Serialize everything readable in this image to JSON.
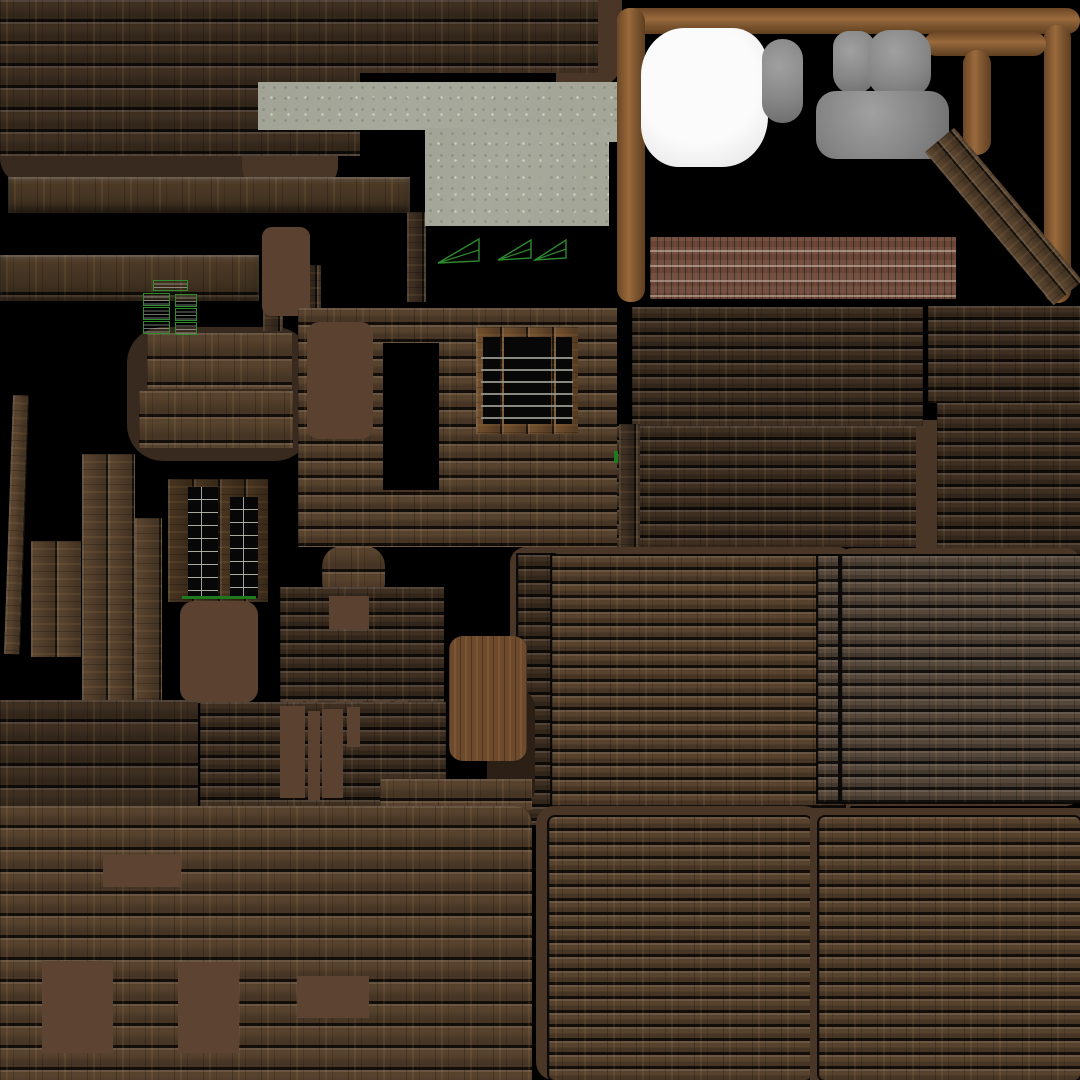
{
  "meta": {
    "background": "#000000",
    "canvas_width": 1080,
    "canvas_height": 1080
  },
  "palette": {
    "background": "#000000",
    "wood_dark": "#3e2f21",
    "wood_mid": "#57422d",
    "wood_gray": "#55473a",
    "flat_brown": "#5a4130",
    "shadow_brown": "#4a3626",
    "blob_brown": "#382a1e",
    "concrete_gray": "#a7a99c",
    "brick_red": "#6f5243",
    "frame_brown": "#9a6a3c",
    "white_blob": "#f3f3f3",
    "gray_blob": "#8f8f8f",
    "wireframe_green": "#2d8a2d"
  },
  "patches": [
    {
      "name": "scallop-shadow-band",
      "cls": "flat",
      "c": "#382a1e",
      "x": 0,
      "y": 132,
      "w": 338,
      "h": 52,
      "r": "0 0 26px 26px"
    },
    {
      "name": "concrete-left-shadow",
      "cls": "flat",
      "c": "#4a3626",
      "x": 242,
      "y": 122,
      "w": 96,
      "h": 68,
      "r": "24px"
    },
    {
      "name": "topwood-right-shadow",
      "cls": "flat",
      "c": "#4a3626",
      "x": 556,
      "y": 0,
      "w": 66,
      "h": 88,
      "r": "0 0 28px 0"
    },
    {
      "name": "topleft-wood-lower",
      "cls": "wood rows-22 shade-dark",
      "x": 0,
      "y": 0,
      "w": 360,
      "h": 156
    },
    {
      "name": "topleft-wood-upper",
      "cls": "wood rows-22 shade-dark",
      "x": 0,
      "y": 0,
      "w": 598,
      "h": 73
    },
    {
      "name": "beam-1",
      "cls": "wood rows-40 shade-beam beam",
      "x": 8,
      "y": 177,
      "w": 402,
      "h": 36
    },
    {
      "name": "post-1",
      "cls": "vgrain rows-17 shade-dark",
      "x": 407,
      "y": 212,
      "w": 19,
      "h": 90
    },
    {
      "name": "beam-2",
      "cls": "wood rows-40 shade-beam beam",
      "x": 0,
      "y": 255,
      "w": 259,
      "h": 46
    },
    {
      "name": "concrete-slab",
      "cls": "concrete",
      "x": 258,
      "y": 82,
      "w": 366,
      "h": 48
    },
    {
      "name": "concrete-block",
      "cls": "concrete",
      "x": 425,
      "y": 128,
      "w": 184,
      "h": 98
    },
    {
      "name": "concrete-step",
      "cls": "concrete",
      "x": 592,
      "y": 128,
      "w": 32,
      "h": 14
    },
    {
      "name": "frame-top-bar",
      "cls": "frame",
      "x": 617,
      "y": 8,
      "w": 463,
      "h": 26,
      "r": "13px"
    },
    {
      "name": "frame-left-bar",
      "cls": "frame dirH",
      "x": 617,
      "y": 8,
      "w": 28,
      "h": 294,
      "r": "13px"
    },
    {
      "name": "frame-right-bar",
      "cls": "frame dirH",
      "x": 1044,
      "y": 25,
      "w": 27,
      "h": 278,
      "r": "13px"
    },
    {
      "name": "frame-t-bar",
      "cls": "frame",
      "x": 924,
      "y": 32,
      "w": 122,
      "h": 24,
      "r": "12px"
    },
    {
      "name": "frame-t-stem",
      "cls": "frame dirH",
      "x": 963,
      "y": 50,
      "w": 28,
      "h": 105,
      "r": "14px"
    },
    {
      "name": "white-blob",
      "cls": "whiteblob",
      "x": 641,
      "y": 28,
      "w": 127,
      "h": 139,
      "r": "34% 28% 36% 30%"
    },
    {
      "name": "gray-blob-small",
      "cls": "grayblob",
      "x": 762,
      "y": 39,
      "w": 41,
      "h": 84,
      "r": "20px"
    },
    {
      "name": "gray-lump-1",
      "cls": "grayblob",
      "x": 833,
      "y": 31,
      "w": 42,
      "h": 63,
      "r": "16px 16px 20px 20px"
    },
    {
      "name": "gray-lump-2",
      "cls": "grayblob",
      "x": 868,
      "y": 30,
      "w": 63,
      "h": 67,
      "r": "22px"
    },
    {
      "name": "gray-blob-big",
      "cls": "grayblob",
      "x": 816,
      "y": 91,
      "w": 133,
      "h": 68,
      "r": "20px"
    },
    {
      "name": "diagonal-plank",
      "cls": "vgrain rows-17 shade-mid",
      "x": 925,
      "y": 152,
      "w": 38,
      "h": 200,
      "rot": -40
    },
    {
      "name": "brick-strip",
      "cls": "brick",
      "x": 650,
      "y": 237,
      "w": 306,
      "h": 62
    },
    {
      "name": "brown-gap-right",
      "cls": "flat",
      "c": "#4a3626",
      "x": 1053,
      "y": 394,
      "w": 27,
      "h": 66
    },
    {
      "name": "brown-gap-mid",
      "cls": "flat",
      "c": "#4a3626",
      "x": 916,
      "y": 420,
      "w": 26,
      "h": 142
    },
    {
      "name": "panel-a",
      "cls": "wood rows-14 shade-dark",
      "x": 632,
      "y": 307,
      "w": 291,
      "h": 119
    },
    {
      "name": "panel-b",
      "cls": "wood rows-14 shade-dark",
      "x": 928,
      "y": 306,
      "w": 152,
      "h": 97
    },
    {
      "name": "panel-a2",
      "cls": "wood rows-14 shade-dark",
      "x": 613,
      "y": 426,
      "w": 303,
      "h": 121
    },
    {
      "name": "panel-b2",
      "cls": "wood rows-14 shade-dark",
      "x": 937,
      "y": 403,
      "w": 143,
      "h": 157
    },
    {
      "name": "midleft-blob",
      "cls": "flat",
      "c": "#382a1e",
      "x": 127,
      "y": 327,
      "w": 184,
      "h": 134,
      "r": "36px"
    },
    {
      "name": "plank-row-1",
      "cls": "wood rows-26 shade-mid",
      "x": 147,
      "y": 333,
      "w": 145,
      "h": 56
    },
    {
      "name": "plank-row-2",
      "cls": "wood rows-26 shade-mid",
      "x": 139,
      "y": 391,
      "w": 154,
      "h": 57
    },
    {
      "name": "tall-verticals",
      "cls": "vgrain rows-26 shade-mid",
      "x": 82,
      "y": 454,
      "w": 53,
      "h": 247
    },
    {
      "name": "tall-verticals-2",
      "cls": "vgrain rows-26 shade-mid",
      "x": 135,
      "y": 518,
      "w": 27,
      "h": 182
    },
    {
      "name": "tilted-plank",
      "cls": "vgrain rows-17 shade-mid",
      "x": 13,
      "y": 395,
      "w": 16,
      "h": 259,
      "rot": 2
    },
    {
      "name": "short-verticals",
      "cls": "vgrain rows-26 shade-mid",
      "x": 31,
      "y": 541,
      "w": 50,
      "h": 116
    },
    {
      "name": "vplank-a",
      "cls": "vgrain rows-17 shade-dark",
      "x": 263,
      "y": 265,
      "w": 20,
      "h": 66
    },
    {
      "name": "vplank-b",
      "cls": "vgrain rows-17 shade-dark",
      "x": 300,
      "y": 265,
      "w": 21,
      "h": 147
    },
    {
      "name": "flat-brown-top",
      "cls": "flat",
      "c": "#5a4130",
      "x": 262,
      "y": 227,
      "w": 48,
      "h": 89,
      "r": "10px"
    },
    {
      "name": "window-shutter",
      "cls": "vgrain rows-26",
      "base": "#46331f",
      "x": 168,
      "y": 479,
      "w": 100,
      "h": 123,
      "children": [
        {
          "name": "shutter-pane-left",
          "cls": "pane grid",
          "x": 20,
          "y": 8,
          "w": 30,
          "h": 110
        },
        {
          "name": "shutter-pane-right",
          "cls": "pane grid",
          "x": 62,
          "y": 18,
          "w": 28,
          "h": 101
        },
        {
          "name": "shutter-green-line",
          "cls": "greenline",
          "x": 14,
          "y": 117,
          "w": 74,
          "h": 3
        }
      ]
    },
    {
      "name": "flat-brown-midleft",
      "cls": "flat",
      "c": "#5a4130",
      "x": 180,
      "y": 601,
      "w": 78,
      "h": 102,
      "r": "14px"
    },
    {
      "name": "window-block",
      "cls": "wood rows-17 shade-mid",
      "x": 298,
      "y": 308,
      "w": 319,
      "h": 239
    },
    {
      "name": "window-block-hole",
      "cls": "flat",
      "c": "#000000",
      "x": 383,
      "y": 343,
      "w": 56,
      "h": 147
    },
    {
      "name": "flat-brown-on-block",
      "cls": "flat",
      "c": "#5a4130",
      "x": 307,
      "y": 322,
      "w": 66,
      "h": 117,
      "r": "12px"
    },
    {
      "name": "window-frame",
      "cls": "vgrain rows-26",
      "base": "#6e4d2c",
      "x": 476,
      "y": 327,
      "w": 102,
      "h": 107,
      "children": [
        {
          "name": "window-pane-left",
          "cls": "pane",
          "x": 7,
          "y": 10,
          "w": 17,
          "h": 87
        },
        {
          "name": "window-pane-center",
          "cls": "pane",
          "x": 28,
          "y": 10,
          "w": 47,
          "h": 87
        },
        {
          "name": "window-pane-right",
          "cls": "pane",
          "x": 80,
          "y": 10,
          "w": 16,
          "h": 87
        },
        {
          "name": "window-slats",
          "cls": "bars",
          "x": 5,
          "y": 20,
          "w": 92,
          "h": 72
        }
      ]
    },
    {
      "name": "vstrip-right-of-block",
      "cls": "vgrain rows-17 shade-dark",
      "x": 619,
      "y": 424,
      "w": 21,
      "h": 139
    },
    {
      "name": "green-mark",
      "cls": "greenline",
      "x": 614,
      "y": 451,
      "w": 4,
      "h": 12
    },
    {
      "name": "wood-knob",
      "cls": "wood rows-26 shade-mid",
      "x": 322,
      "y": 546,
      "w": 63,
      "h": 44,
      "r": "20px 20px 6px 6px"
    },
    {
      "name": "panel-k",
      "cls": "wood rows-14 shade-dark",
      "x": 280,
      "y": 587,
      "w": 164,
      "h": 234
    },
    {
      "name": "panel-k-cut-1",
      "cls": "flat",
      "c": "#5a4130",
      "x": 329,
      "y": 596,
      "w": 40,
      "h": 33
    },
    {
      "name": "panel-k-bar-1",
      "cls": "flat",
      "c": "#5a4130",
      "x": 283,
      "y": 701,
      "w": 20,
      "h": 100
    },
    {
      "name": "panel-k-bar-2",
      "cls": "flat",
      "c": "#5a4130",
      "x": 306,
      "y": 701,
      "w": 12,
      "h": 80
    },
    {
      "name": "panel-k-bar-3",
      "cls": "flat",
      "c": "#5a4130",
      "x": 336,
      "y": 701,
      "w": 27,
      "h": 100
    },
    {
      "name": "panel-k-bar-4",
      "cls": "flat",
      "c": "#5a4130",
      "x": 374,
      "y": 701,
      "w": 16,
      "h": 70
    },
    {
      "name": "panel-k-bar-5",
      "cls": "flat",
      "c": "#5a4130",
      "x": 395,
      "y": 701,
      "w": 13,
      "h": 50
    },
    {
      "name": "center-panel-shadow",
      "cls": "flat",
      "c": "#4a3626",
      "x": 510,
      "y": 547,
      "w": 344,
      "h": 266,
      "r": "16px"
    },
    {
      "name": "vstrip-center",
      "cls": "wood rows-14 shade-dark edge",
      "x": 518,
      "y": 555,
      "w": 36,
      "h": 270
    },
    {
      "name": "center-panel",
      "cls": "wood rows-14 shade-mid edge",
      "x": 552,
      "y": 556,
      "w": 292,
      "h": 250
    },
    {
      "name": "door-shadow",
      "cls": "flat",
      "c": "#2c2016",
      "x": 487,
      "y": 688,
      "w": 48,
      "h": 120,
      "r": "20px"
    },
    {
      "name": "door",
      "cls": "door",
      "x": 449,
      "y": 636,
      "w": 78,
      "h": 125,
      "r": "14px"
    },
    {
      "name": "right-panel-shadow",
      "cls": "flat",
      "c": "#4a3626",
      "x": 838,
      "y": 548,
      "w": 242,
      "h": 258,
      "r": "14px"
    },
    {
      "name": "right-panel-col",
      "cls": "wood rows-13 shade-gray edge",
      "x": 818,
      "y": 556,
      "w": 20,
      "h": 246
    },
    {
      "name": "right-panel",
      "cls": "wood rows-13 shade-gray edge",
      "x": 842,
      "y": 556,
      "w": 238,
      "h": 246
    },
    {
      "name": "panel-c",
      "cls": "wood rows-22 shade-dark",
      "x": 0,
      "y": 700,
      "w": 198,
      "h": 110
    },
    {
      "name": "panel-d",
      "cls": "wood rows-14 shade-dark",
      "x": 200,
      "y": 702,
      "w": 246,
      "h": 118
    },
    {
      "name": "panel-d-bar-1",
      "cls": "flat",
      "c": "#5a4130",
      "x": 280,
      "y": 706,
      "w": 25,
      "h": 92
    },
    {
      "name": "panel-d-bar-2",
      "cls": "flat",
      "c": "#5a4130",
      "x": 308,
      "y": 711,
      "w": 12,
      "h": 89
    },
    {
      "name": "panel-d-bar-3",
      "cls": "flat",
      "c": "#5a4130",
      "x": 322,
      "y": 709,
      "w": 21,
      "h": 89
    },
    {
      "name": "panel-d-bar-4",
      "cls": "flat",
      "c": "#5a4130",
      "x": 347,
      "y": 707,
      "w": 13,
      "h": 40
    },
    {
      "name": "bottomleft-top-patch",
      "cls": "wood rows-22 shade-mid",
      "x": 380,
      "y": 779,
      "w": 152,
      "h": 31
    },
    {
      "name": "bottomleft-panel",
      "cls": "wood rows-22 shade-mid",
      "x": 0,
      "y": 806,
      "w": 532,
      "h": 274,
      "r": "0 18px 0 0"
    },
    {
      "name": "bl-cut-1",
      "cls": "flat",
      "c": "#5d4331",
      "x": 103,
      "y": 855,
      "w": 78,
      "h": 32
    },
    {
      "name": "bl-cut-2",
      "cls": "flat",
      "c": "#5d4331",
      "x": 42,
      "y": 961,
      "w": 71,
      "h": 92
    },
    {
      "name": "bl-cut-3",
      "cls": "flat",
      "c": "#5d4331",
      "x": 178,
      "y": 962,
      "w": 61,
      "h": 91
    },
    {
      "name": "bl-cut-4",
      "cls": "flat",
      "c": "#5d4331",
      "x": 297,
      "y": 976,
      "w": 72,
      "h": 42
    },
    {
      "name": "bottommid-shadow",
      "cls": "flat",
      "c": "#4a3626",
      "x": 536,
      "y": 806,
      "w": 286,
      "h": 274,
      "r": "18px"
    },
    {
      "name": "bottommid-panel",
      "cls": "wood rows-14 shade-mid edge",
      "x": 549,
      "y": 817,
      "w": 262,
      "h": 263,
      "r": "6px"
    },
    {
      "name": "bottomright-shadow",
      "cls": "flat",
      "c": "#4a3626",
      "x": 810,
      "y": 808,
      "w": 270,
      "h": 272
    },
    {
      "name": "bottomright-panel",
      "cls": "wood rows-14 shade-mid edge",
      "x": 819,
      "y": 817,
      "w": 261,
      "h": 263,
      "r": "6px"
    },
    {
      "name": "wireframe-triangle-1",
      "cls": "tri",
      "svg": "tri",
      "x": 436,
      "y": 237,
      "w": 45,
      "h": 29
    },
    {
      "name": "wireframe-triangle-2",
      "cls": "tri",
      "svg": "tri",
      "x": 496,
      "y": 238,
      "w": 37,
      "h": 25
    },
    {
      "name": "wireframe-triangle-3",
      "cls": "tri",
      "svg": "tri",
      "x": 533,
      "y": 238,
      "w": 35,
      "h": 25
    },
    {
      "name": "wireframe-ladder-top",
      "cls": "ladder",
      "x": 153,
      "y": 280,
      "w": 35,
      "h": 11
    },
    {
      "name": "wireframe-ladder-l1",
      "cls": "ladder",
      "x": 143,
      "y": 293,
      "w": 27,
      "h": 13
    },
    {
      "name": "wireframe-ladder-l2",
      "cls": "ladder",
      "x": 143,
      "y": 307,
      "w": 27,
      "h": 13
    },
    {
      "name": "wireframe-ladder-l3",
      "cls": "ladder",
      "x": 143,
      "y": 321,
      "w": 27,
      "h": 13
    },
    {
      "name": "wireframe-ladder-r1",
      "cls": "ladder",
      "x": 175,
      "y": 294,
      "w": 22,
      "h": 13
    },
    {
      "name": "wireframe-ladder-r2",
      "cls": "ladder",
      "x": 175,
      "y": 308,
      "w": 22,
      "h": 13
    },
    {
      "name": "wireframe-ladder-r3",
      "cls": "ladder",
      "x": 175,
      "y": 322,
      "w": 22,
      "h": 13
    }
  ]
}
